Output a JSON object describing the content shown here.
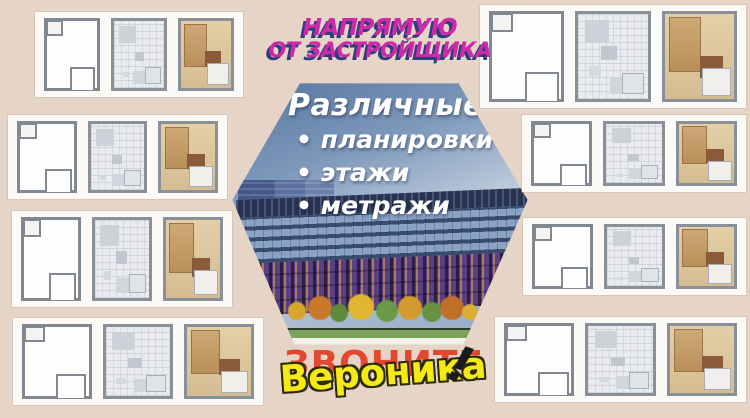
{
  "theme": {
    "background": "#e6d5c7",
    "card_bg": "#fbfaf7",
    "magenta": "#cf28a8",
    "magenta_shadow": "#2c3f7d",
    "call_red": "#e0492f",
    "name_yellow": "#f5e916",
    "sky_top": "#55749f",
    "sky_light": "#bccadb"
  },
  "header": {
    "line1": "НАПРЯМУЮ",
    "line2": "ОТ ЗАСТРОЙЩИКА"
  },
  "hexagon": {
    "title": "Различные",
    "bullet_char": "•",
    "bullets": [
      "планировки",
      "этажи",
      "метражи"
    ]
  },
  "footer": {
    "call": "ЗВОНИТЕ",
    "name": "Вероника",
    "exclaim": "!"
  },
  "building": {
    "trees": [
      {
        "x": 58,
        "y": 220,
        "s": 18,
        "color": "#d8a62e"
      },
      {
        "x": 78,
        "y": 214,
        "s": 24,
        "color": "#c8792b"
      },
      {
        "x": 100,
        "y": 222,
        "s": 18,
        "color": "#5f8a3c"
      },
      {
        "x": 118,
        "y": 212,
        "s": 26,
        "color": "#e0b52f"
      },
      {
        "x": 146,
        "y": 218,
        "s": 22,
        "color": "#6a9a45"
      },
      {
        "x": 168,
        "y": 214,
        "s": 24,
        "color": "#d39a2d"
      },
      {
        "x": 192,
        "y": 220,
        "s": 20,
        "color": "#679040"
      },
      {
        "x": 210,
        "y": 214,
        "s": 24,
        "color": "#bf6f28"
      },
      {
        "x": 232,
        "y": 222,
        "s": 16,
        "color": "#dcae33"
      }
    ]
  },
  "plan_cards": [
    {
      "name": "card-top-left",
      "x": 35,
      "y": 12,
      "w": 208,
      "h": 85,
      "plans": [
        "outline",
        "grey",
        "color"
      ]
    },
    {
      "name": "card-left-2",
      "x": 8,
      "y": 115,
      "w": 219,
      "h": 84,
      "plans": [
        "outline",
        "grey",
        "color"
      ]
    },
    {
      "name": "card-left-3",
      "x": 12,
      "y": 211,
      "w": 220,
      "h": 96,
      "plans": [
        "outline",
        "grey",
        "color"
      ]
    },
    {
      "name": "card-bottom-left",
      "x": 13,
      "y": 318,
      "w": 250,
      "h": 87,
      "plans": [
        "outline",
        "grey",
        "color"
      ]
    },
    {
      "name": "card-top-right",
      "x": 480,
      "y": 5,
      "w": 266,
      "h": 103,
      "plans": [
        "outline",
        "grey",
        "color"
      ]
    },
    {
      "name": "card-right-2",
      "x": 522,
      "y": 115,
      "w": 224,
      "h": 77,
      "plans": [
        "outline",
        "grey",
        "color"
      ]
    },
    {
      "name": "card-right-3",
      "x": 523,
      "y": 218,
      "w": 223,
      "h": 77,
      "plans": [
        "outline",
        "grey",
        "color"
      ]
    },
    {
      "name": "card-bottom-right",
      "x": 495,
      "y": 317,
      "w": 251,
      "h": 85,
      "plans": [
        "outline",
        "grey",
        "color"
      ]
    }
  ]
}
